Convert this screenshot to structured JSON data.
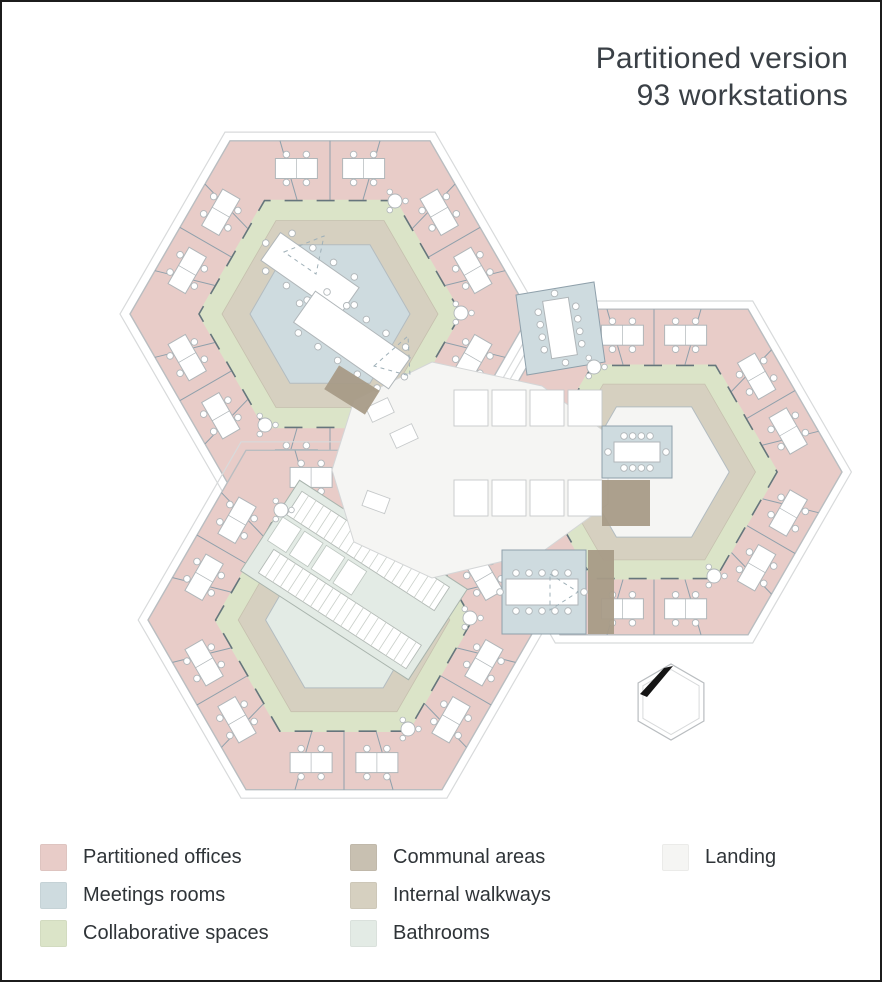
{
  "title": {
    "line1": "Partitioned version",
    "line2": "93 workstations"
  },
  "legend": {
    "columns": [
      {
        "items": [
          {
            "id": "offices",
            "label": "Partitioned offices"
          },
          {
            "id": "meetings",
            "label": "Meetings rooms"
          },
          {
            "id": "collaborative",
            "label": "Collaborative spaces"
          }
        ]
      },
      {
        "items": [
          {
            "id": "communal",
            "label": "Communal areas"
          },
          {
            "id": "walkways",
            "label": "Internal walkways"
          },
          {
            "id": "bathrooms",
            "label": "Bathrooms"
          }
        ]
      },
      {
        "items": [
          {
            "id": "landing",
            "label": "Landing"
          }
        ]
      }
    ]
  },
  "colors": {
    "offices": "#e8ccc8",
    "meetings": "#cedbdf",
    "collaborative": "#dbe4c8",
    "communal": "#c8c0b1",
    "communal_dark": "#a89b87",
    "walkways": "#d6d0c0",
    "bathrooms": "#e3ebe5",
    "landing": "#f5f5f3",
    "outline": "#b9bdc0",
    "outline_light": "#d8dadb",
    "partition": "#8fa0ab",
    "wall_dark": "#51626f",
    "furniture_stroke": "#b0b6b9",
    "north_marker": "#151515",
    "title_text": "#3a4046",
    "legend_text": "#2f3438"
  }
}
